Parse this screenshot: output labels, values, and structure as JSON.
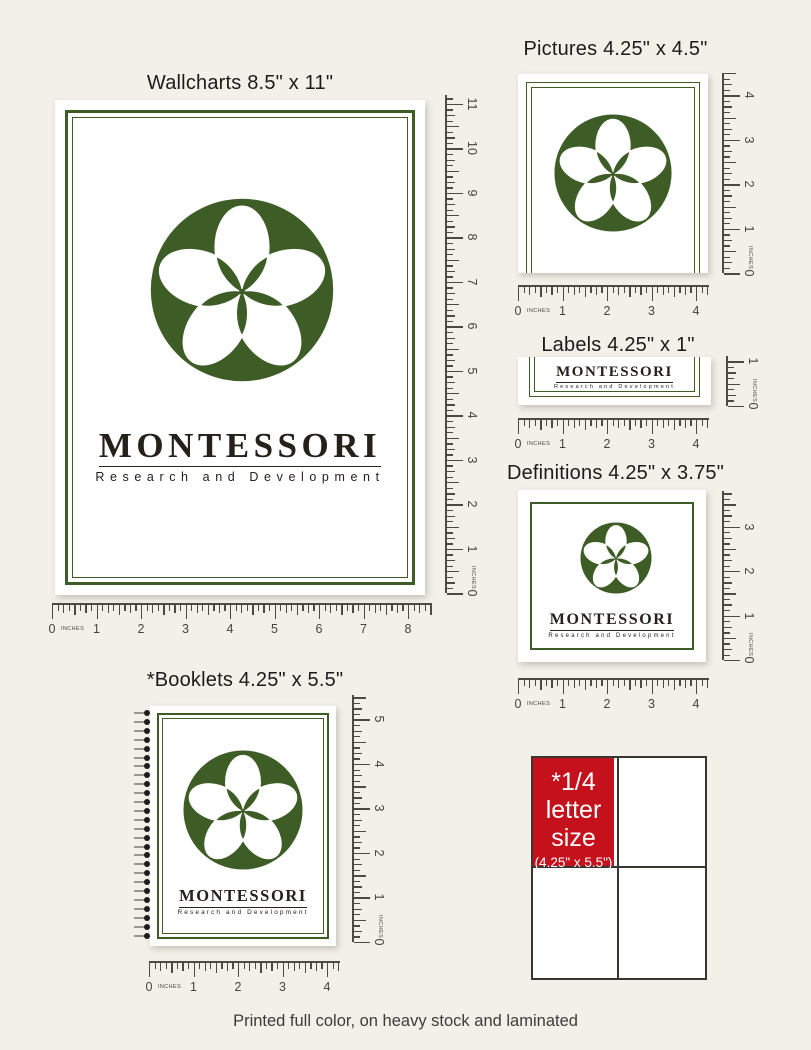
{
  "page": {
    "background": "#f2f0e9",
    "caption": "Printed full color, on heavy stock and laminated"
  },
  "brand": {
    "name": "MONTESSORI",
    "tagline": "Research and Development",
    "green": "#3e5d26",
    "red": "#c4111c"
  },
  "sections": {
    "wallcharts": {
      "title": "Wallcharts 8.5\" x 11\""
    },
    "pictures": {
      "title": "Pictures 4.25\" x 4.5\""
    },
    "labels": {
      "title": "Labels 4.25\" x 1\""
    },
    "definitions": {
      "title": "Definitions 4.25\" x 3.75\""
    },
    "booklets": {
      "title": "*Booklets 4.25\" x 5.5\""
    }
  },
  "quarter_note": {
    "line1": "*1/4",
    "line2": "letter",
    "line3": "size",
    "size_label": "(4.25\" x 5.5\")"
  },
  "rulers": {
    "inches_label": "INCHES",
    "wallchart_v": {
      "length_in": 11.2,
      "numbers": [
        "0",
        "1",
        "2",
        "3",
        "4",
        "5",
        "6",
        "7",
        "8",
        "9",
        "10",
        "11"
      ]
    },
    "wallchart_h": {
      "length_in": 8.55,
      "numbers": [
        "0",
        "1",
        "2",
        "3",
        "4",
        "5",
        "6",
        "7",
        "8"
      ]
    },
    "pictures_v": {
      "length_in": 4.5,
      "numbers": [
        "0",
        "1",
        "2",
        "3",
        "4"
      ]
    },
    "pictures_h": {
      "length_in": 4.3,
      "numbers": [
        "0",
        "1",
        "2",
        "3",
        "4"
      ]
    },
    "labels_v": {
      "length_in": 1.12,
      "numbers": [
        "0",
        "1"
      ]
    },
    "labels_h": {
      "length_in": 4.3,
      "numbers": [
        "0",
        "1",
        "2",
        "3",
        "4"
      ]
    },
    "definitions_v": {
      "length_in": 3.8,
      "numbers": [
        "0",
        "1",
        "2",
        "3"
      ]
    },
    "definitions_h": {
      "length_in": 4.3,
      "numbers": [
        "0",
        "1",
        "2",
        "3",
        "4"
      ]
    },
    "booklets_v": {
      "length_in": 5.55,
      "numbers": [
        "0",
        "1",
        "2",
        "3",
        "4",
        "5"
      ]
    },
    "booklets_h": {
      "length_in": 4.3,
      "numbers": [
        "0",
        "1",
        "2",
        "3",
        "4"
      ]
    }
  }
}
